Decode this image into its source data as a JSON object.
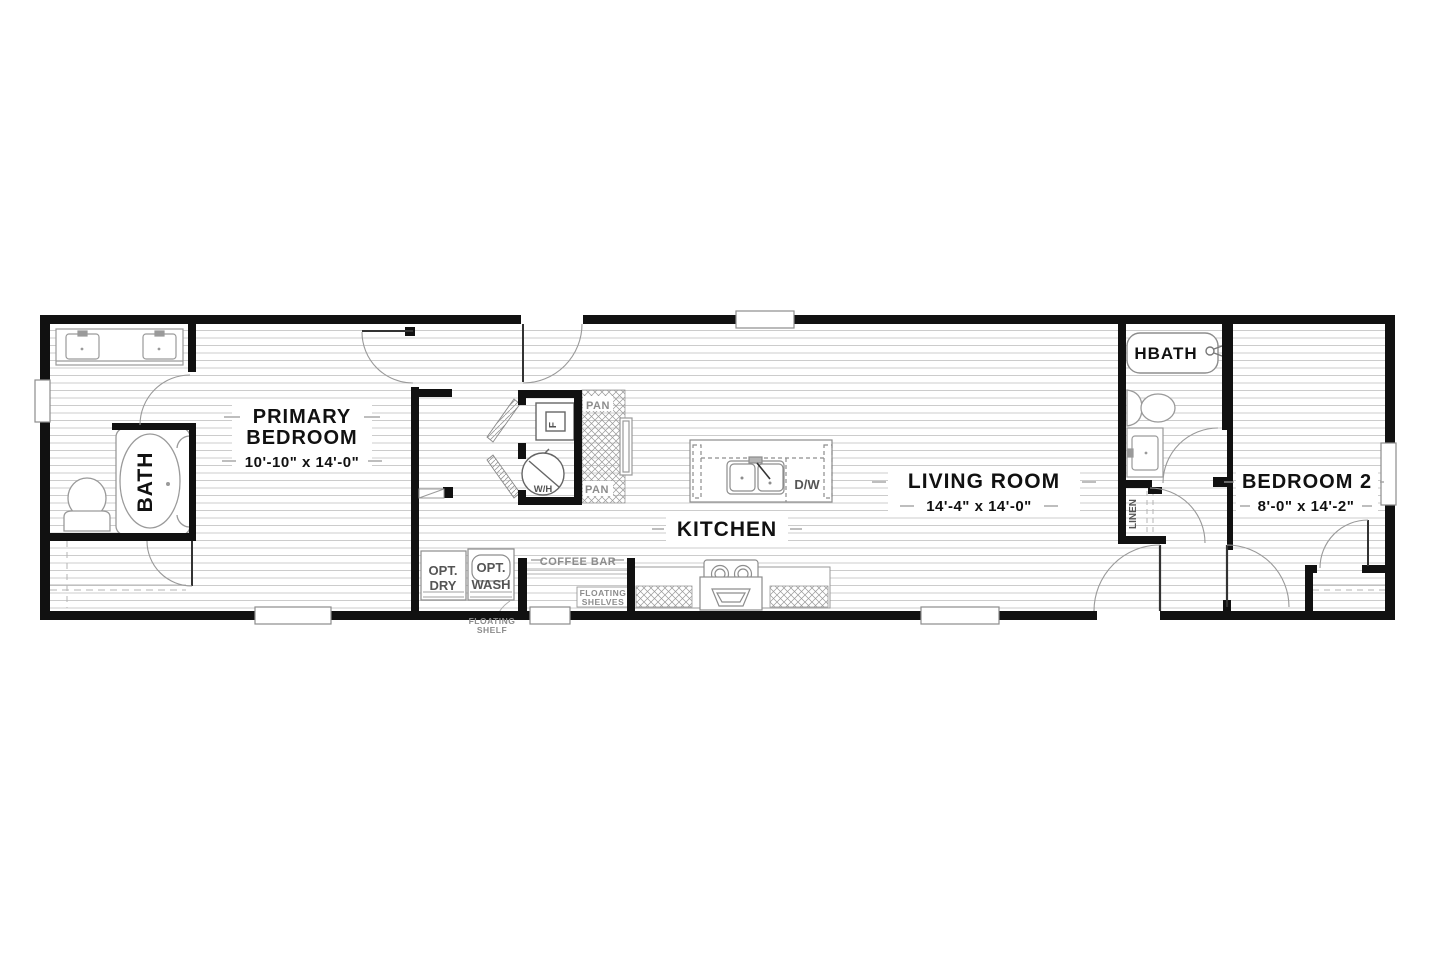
{
  "plan_title": "Single-section home floor plan",
  "rooms": {
    "primary": {
      "line1": "PRIMARY",
      "line2": "BEDROOM",
      "dims": "10'-10\" x  14'-0\""
    },
    "bath": {
      "label": "BATH"
    },
    "kitchen": {
      "label": "KITCHEN"
    },
    "living": {
      "label": "LIVING ROOM",
      "dims": "14'-4\" x  14'-0\""
    },
    "hbath": {
      "label": "HBATH"
    },
    "bedroom2": {
      "label": "BEDROOM 2",
      "dims": "8'-0\" x  14'-2\""
    },
    "linen": {
      "label": "LINEN"
    }
  },
  "fixtures": {
    "pan_top": "PAN",
    "pan_bottom": "PAN",
    "furnace": "F",
    "water_heater": "W/H",
    "dishwasher": "D/W",
    "opt_dry_line1": "OPT.",
    "opt_dry_line2": "DRY",
    "opt_wash_line1": "OPT.",
    "opt_wash_line2": "WASH",
    "coffee_bar": "COFFEE BAR",
    "floating_shelves_line1": "FLOATING",
    "floating_shelves_line2": "SHELVES",
    "floating_shelf_line1": "FLOATING",
    "floating_shelf_line2": "SHELF"
  },
  "colors": {
    "wall": "#111111",
    "floor_line": "#cccccc",
    "label_gray": "#8c8c8c"
  }
}
